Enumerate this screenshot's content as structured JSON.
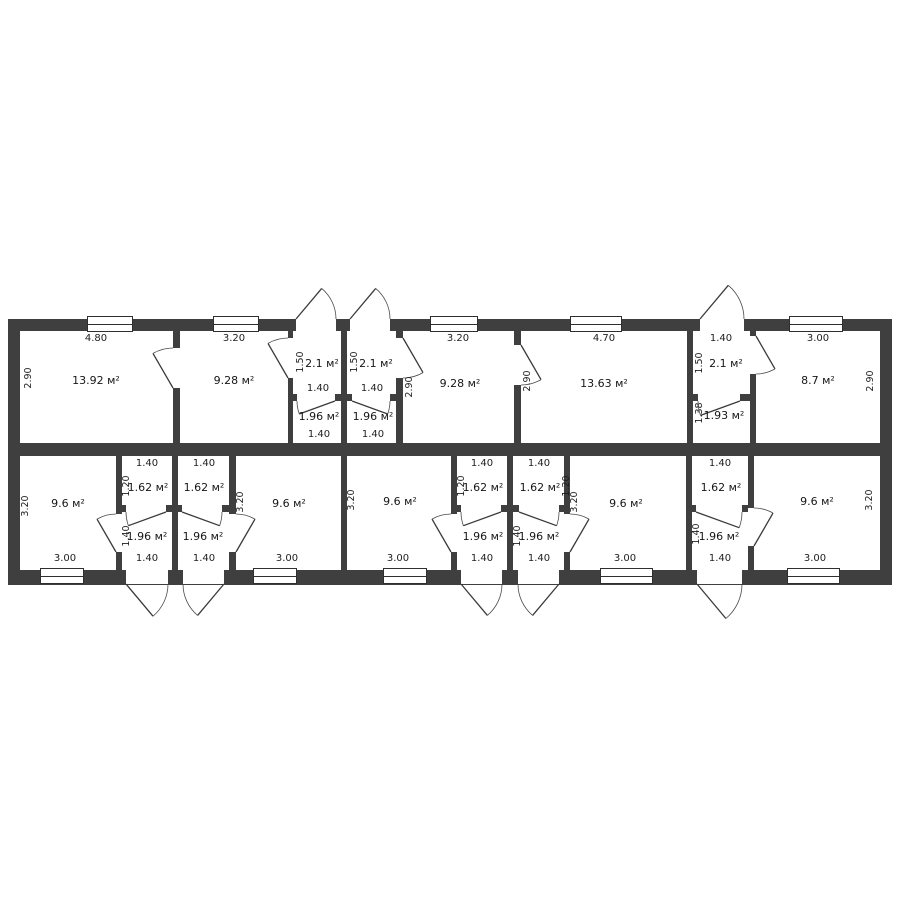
{
  "watermark": "etagi",
  "top": {
    "r1": {
      "area": "13.92 м²",
      "w": "4.80",
      "d": "2.90"
    },
    "r2": {
      "area": "9.28 м²",
      "w": "3.20"
    },
    "h1": {
      "area": "2.1 м²",
      "d": "1.50",
      "door": "1.40",
      "wc": "1.96 м²",
      "wcb": "1.40"
    },
    "h2": {
      "area": "2.1 м²",
      "d": "1.50",
      "door": "1.40",
      "wc": "1.96 м²",
      "wcb": "1.40"
    },
    "r3": {
      "area": "9.28 м²",
      "w": "3.20",
      "d": "2.90"
    },
    "r4": {
      "area": "13.63 м²",
      "w": "4.70",
      "d": "2.90"
    },
    "h3": {
      "area": "2.1 м²",
      "w": "1.40",
      "d": "1.50",
      "wc": "1.93 м²",
      "wcd": "1.38"
    },
    "r5": {
      "area": "8.7 м²",
      "w": "3.00",
      "d": "2.90"
    }
  },
  "bottom": {
    "b1": {
      "area": "9.6 м²",
      "w": "3.00",
      "d": "3.20"
    },
    "u1": {
      "t": "1.40",
      "c": "1.62 м²",
      "cd": "1.20",
      "wc": "1.96 м²",
      "wcd": "1.40",
      "b": "1.40"
    },
    "u2": {
      "t": "1.40",
      "c": "1.62 м²",
      "wc": "1.96 м²",
      "b": "1.40"
    },
    "b2": {
      "area": "9.6 м²",
      "w": "3.00",
      "d": "3.20"
    },
    "b3": {
      "area": "9.6 м²",
      "w": "3.00",
      "d": "3.20"
    },
    "u3": {
      "t": "1.40",
      "c": "1.62 м²",
      "cd": "1.20",
      "wc": "1.96 м²",
      "b": "1.40"
    },
    "u4": {
      "t": "1.40",
      "c": "1.62 м²",
      "cd": "1.20",
      "wc": "1.96 м²",
      "wcd": "1.40",
      "b": "1.40"
    },
    "b4": {
      "area": "9.6 м²",
      "w": "3.00",
      "d": "3.20"
    },
    "u5": {
      "t": "1.40",
      "c": "1.62 м²",
      "wc": "1.96 м²",
      "wcd": "1.40",
      "b": "1.40"
    },
    "b5": {
      "area": "9.6 м²",
      "w": "3.00",
      "d": "3.20"
    }
  }
}
